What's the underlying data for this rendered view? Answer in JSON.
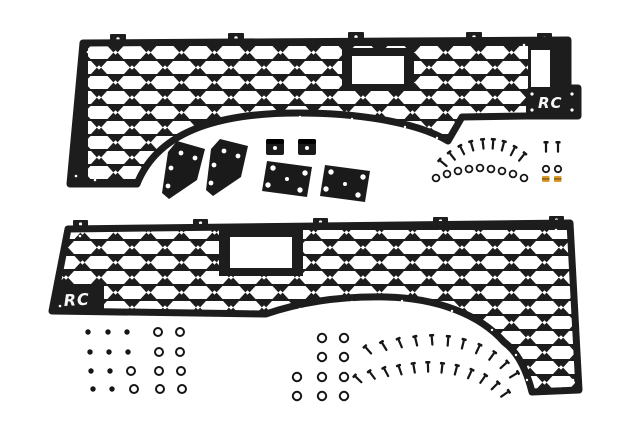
{
  "image": {
    "width": 640,
    "height": 427,
    "background": "#ffffff",
    "description": "Product photo: pair of black hex-grid truck bed molle panels with mounting brackets and hardware"
  },
  "colors": {
    "panel": "#1d1d1d",
    "hardware": "#161616",
    "gold": "#d9992e",
    "gold_dark": "#8a5f12",
    "logo": "#f7f7f7",
    "white": "#ffffff"
  },
  "panels": {
    "top": {
      "logo_text": "RC",
      "logo_side": "right"
    },
    "bottom": {
      "logo_text": "RC",
      "logo_side": "left"
    }
  },
  "kit": {
    "panel_count": 2,
    "angled_bracket_count": 2,
    "plate_bracket_count": 2,
    "clip_count": 2
  },
  "hardware": {
    "top_screw_fan": [
      [
        443,
        163,
        -50
      ],
      [
        452,
        156,
        -38
      ],
      [
        462,
        150,
        -27
      ],
      [
        472,
        146,
        -16
      ],
      [
        483,
        144,
        -6
      ],
      [
        493,
        144,
        4
      ],
      [
        503,
        146,
        15
      ],
      [
        513,
        151,
        27
      ],
      [
        522,
        157,
        39
      ]
    ],
    "top_washer_arc": [
      [
        436,
        178
      ],
      [
        447,
        174
      ],
      [
        458,
        171
      ],
      [
        469,
        169
      ],
      [
        480,
        168
      ],
      [
        491,
        169
      ],
      [
        502,
        171
      ],
      [
        513,
        174
      ],
      [
        524,
        178
      ]
    ],
    "pair_screws": [
      [
        546,
        147
      ],
      [
        558,
        147
      ]
    ],
    "pair_washers": [
      [
        546,
        169
      ],
      [
        558,
        169
      ]
    ],
    "gold_clips": [
      [
        542,
        176
      ],
      [
        554,
        176
      ]
    ],
    "nut_grid_dots": [
      [
        88,
        332
      ],
      [
        108,
        332
      ],
      [
        127,
        332
      ],
      [
        90,
        352
      ],
      [
        109,
        352
      ],
      [
        128,
        352
      ],
      [
        91,
        371
      ],
      [
        110,
        371
      ],
      [
        93,
        389
      ],
      [
        112,
        389
      ]
    ],
    "nut_grid_washers": [
      [
        158,
        332
      ],
      [
        180,
        332
      ],
      [
        159,
        352
      ],
      [
        180,
        352
      ],
      [
        131,
        371
      ],
      [
        159,
        371
      ],
      [
        181,
        371
      ],
      [
        134,
        389
      ],
      [
        160,
        389
      ],
      [
        182,
        389
      ]
    ],
    "mid_washers": [
      [
        322,
        338
      ],
      [
        344,
        338
      ],
      [
        322,
        357
      ],
      [
        344,
        357
      ],
      [
        297,
        377
      ],
      [
        322,
        377
      ],
      [
        344,
        377
      ],
      [
        297,
        396
      ],
      [
        322,
        396
      ],
      [
        344,
        396
      ]
    ],
    "fan_outer": [
      [
        368,
        350,
        -42
      ],
      [
        384,
        346,
        -32
      ],
      [
        400,
        343,
        -23
      ],
      [
        416,
        341,
        -14
      ],
      [
        432,
        340,
        -5
      ],
      [
        448,
        341,
        4
      ],
      [
        463,
        344,
        14
      ],
      [
        478,
        349,
        25
      ],
      [
        492,
        356,
        36
      ],
      [
        504,
        365,
        48
      ],
      [
        514,
        375,
        58
      ]
    ],
    "fan_inner": [
      [
        358,
        379,
        -46
      ],
      [
        372,
        375,
        -37
      ],
      [
        386,
        372,
        -28
      ],
      [
        400,
        370,
        -19
      ],
      [
        414,
        368,
        -10
      ],
      [
        428,
        367,
        -2
      ],
      [
        442,
        368,
        6
      ],
      [
        456,
        370,
        15
      ],
      [
        470,
        374,
        25
      ],
      [
        483,
        379,
        35
      ],
      [
        495,
        386,
        45
      ],
      [
        505,
        394,
        55
      ]
    ]
  }
}
